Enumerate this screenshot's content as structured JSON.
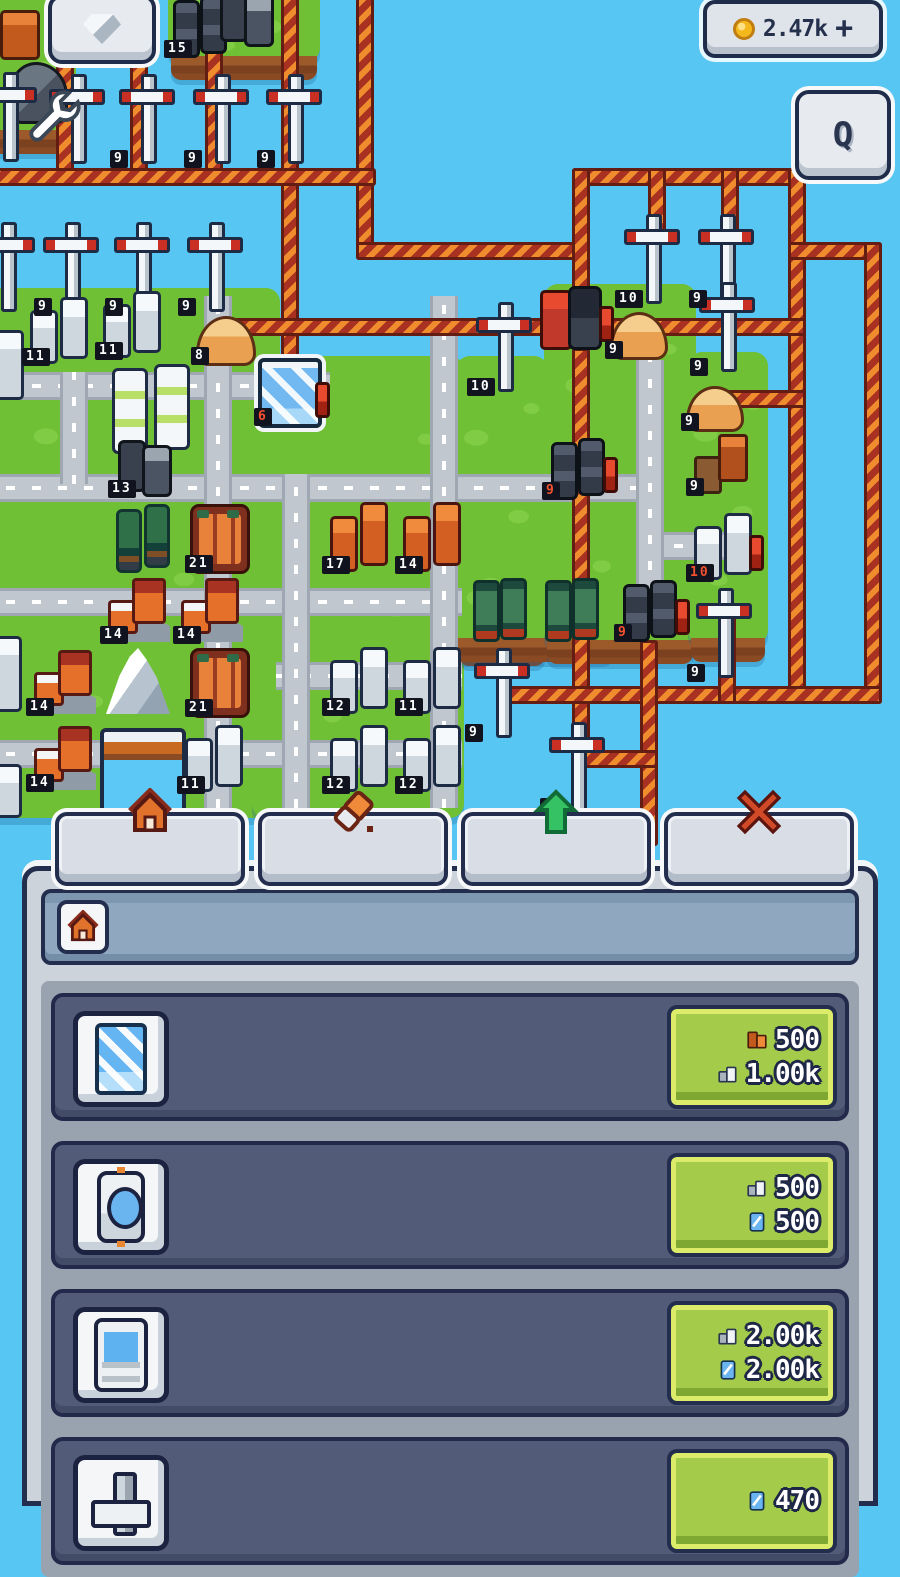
{
  "hud": {
    "gem_button": {
      "icon": "gem-icon"
    },
    "currency": {
      "icon": "coin-icon",
      "value": "2.47k",
      "plus": "+"
    },
    "q_button": {
      "label": "Q"
    },
    "wrench_cursor": {
      "icon": "wrench-icon"
    }
  },
  "tabs": [
    {
      "name": "build",
      "icon": "house-icon"
    },
    {
      "name": "erase",
      "icon": "eraser-icon"
    },
    {
      "name": "upgrade",
      "icon": "arrow-up-icon"
    },
    {
      "name": "close",
      "icon": "x-icon"
    }
  ],
  "panel": {
    "header_icon": "house-icon",
    "items": [
      {
        "icon": "glass-pane",
        "costs": [
          {
            "resource": "bricks",
            "amount": "500"
          },
          {
            "resource": "stone",
            "amount": "1.00k"
          }
        ]
      },
      {
        "icon": "watch",
        "costs": [
          {
            "resource": "stone",
            "amount": "500"
          },
          {
            "resource": "glass",
            "amount": "500"
          }
        ]
      },
      {
        "icon": "window",
        "costs": [
          {
            "resource": "stone",
            "amount": "2.00k"
          },
          {
            "resource": "glass",
            "amount": "2.00k"
          }
        ]
      },
      {
        "icon": "cross",
        "costs": [
          {
            "resource": "glass",
            "amount": "470"
          }
        ]
      }
    ]
  },
  "colors": {
    "water": "#58c6f3",
    "grass": "#70c035",
    "cliff": "#9c5a2b",
    "pipe_orange": "#ef8c2e",
    "pipe_red": "#a93121",
    "road": "#c0c7cf",
    "panel_slate": "#525c79",
    "cost_green": "#a4cc4a",
    "accent_navy": "#232d4d",
    "badge_bg": "#11141f",
    "badge_red_text": "#f4502e",
    "coin_gold": "#f5b81c"
  },
  "map": {
    "islands": [
      {
        "x": -20,
        "y": -16,
        "w": 96,
        "h": 152,
        "cliff": true
      },
      {
        "x": 168,
        "y": -16,
        "w": 152,
        "h": 78,
        "cliff": true
      },
      {
        "x": -20,
        "y": 288,
        "w": 300,
        "h": 530
      },
      {
        "x": 252,
        "y": 356,
        "w": 212,
        "h": 462
      },
      {
        "x": 456,
        "y": 356,
        "w": 92,
        "h": 292,
        "cliff": true
      },
      {
        "x": 440,
        "y": 580,
        "w": 176,
        "h": 64,
        "cliff": true
      },
      {
        "x": 544,
        "y": 284,
        "w": 152,
        "h": 362,
        "cliff": true
      },
      {
        "x": 688,
        "y": 352,
        "w": 80,
        "h": 292,
        "cliff": true
      }
    ],
    "roads": [
      {
        "o": "h",
        "x": -20,
        "y": 372,
        "l": 350
      },
      {
        "o": "h",
        "x": -20,
        "y": 474,
        "l": 680
      },
      {
        "o": "h",
        "x": -20,
        "y": 588,
        "l": 482
      },
      {
        "o": "h",
        "x": 276,
        "y": 662,
        "l": 186
      },
      {
        "o": "h",
        "x": -20,
        "y": 740,
        "l": 482
      },
      {
        "o": "h",
        "x": 648,
        "y": 532,
        "l": 92
      },
      {
        "o": "v",
        "x": 60,
        "y": 372,
        "l": 112
      },
      {
        "o": "v",
        "x": 204,
        "y": 296,
        "l": 512
      },
      {
        "o": "v",
        "x": 282,
        "y": 474,
        "l": 334
      },
      {
        "o": "v",
        "x": 430,
        "y": 296,
        "l": 512
      },
      {
        "o": "v",
        "x": 636,
        "y": 360,
        "l": 262
      }
    ],
    "pipes": [
      {
        "o": "v",
        "x": 56,
        "y": -4,
        "l": 182
      },
      {
        "o": "v",
        "x": 130,
        "y": -4,
        "l": 182
      },
      {
        "o": "v",
        "x": 205,
        "y": -4,
        "l": 182
      },
      {
        "o": "v",
        "x": 281,
        "y": -4,
        "l": 400
      },
      {
        "o": "v",
        "x": 356,
        "y": -4,
        "l": 258
      },
      {
        "o": "h",
        "x": -10,
        "y": 168,
        "l": 380
      },
      {
        "o": "h",
        "x": 572,
        "y": 168,
        "l": 228
      },
      {
        "o": "h",
        "x": 356,
        "y": 242,
        "l": 228
      },
      {
        "o": "v",
        "x": 572,
        "y": 168,
        "l": 132
      },
      {
        "o": "v",
        "x": 648,
        "y": 168,
        "l": 70
      },
      {
        "o": "v",
        "x": 721,
        "y": 168,
        "l": 70
      },
      {
        "o": "v",
        "x": 788,
        "y": 168,
        "l": 528
      },
      {
        "o": "h",
        "x": 788,
        "y": 242,
        "l": 88
      },
      {
        "o": "v",
        "x": 864,
        "y": 242,
        "l": 456
      },
      {
        "o": "h",
        "x": 228,
        "y": 318,
        "l": 572
      },
      {
        "o": "h",
        "x": 712,
        "y": 390,
        "l": 88
      },
      {
        "o": "v",
        "x": 572,
        "y": 348,
        "l": 412
      },
      {
        "o": "h",
        "x": 500,
        "y": 686,
        "l": 376
      },
      {
        "o": "v",
        "x": 640,
        "y": 640,
        "l": 200
      },
      {
        "o": "v",
        "x": 718,
        "y": 610,
        "l": 88
      },
      {
        "o": "h",
        "x": 580,
        "y": 750,
        "l": 72
      }
    ],
    "entities": [
      {
        "type": "crate",
        "x": 0,
        "y": 10
      },
      {
        "type": "rock",
        "x": 10,
        "y": 62
      },
      {
        "type": "vans",
        "x": 172,
        "y": -4,
        "badge": "15"
      },
      {
        "type": "truck",
        "x": 218,
        "y": -10
      },
      {
        "type": "wind-turbine",
        "x": -20,
        "y": 72
      },
      {
        "type": "wind-turbine",
        "x": 48,
        "y": 74
      },
      {
        "type": "wind-turbine",
        "x": 118,
        "y": 74,
        "badge": "9"
      },
      {
        "type": "wind-turbine",
        "x": 192,
        "y": 74,
        "badge": "9"
      },
      {
        "type": "wind-turbine",
        "x": 265,
        "y": 74,
        "badge": "9"
      },
      {
        "type": "wind-turbine",
        "x": -22,
        "y": 222
      },
      {
        "type": "wind-turbine",
        "x": 42,
        "y": 222,
        "badge": "9"
      },
      {
        "type": "wind-turbine",
        "x": 113,
        "y": 222,
        "badge": "9"
      },
      {
        "type": "wind-turbine",
        "x": 186,
        "y": 222,
        "badge": "9"
      },
      {
        "type": "wind-turbine",
        "x": 623,
        "y": 214,
        "badge": "10"
      },
      {
        "type": "wind-turbine",
        "x": 697,
        "y": 214,
        "badge": "9"
      },
      {
        "type": "wind-turbine",
        "x": 698,
        "y": 282,
        "badge": "9"
      },
      {
        "type": "wind-turbine",
        "x": 475,
        "y": 302,
        "badge": "10"
      },
      {
        "type": "wind-turbine",
        "x": 473,
        "y": 648,
        "badge": "9"
      },
      {
        "type": "wind-turbine",
        "x": 548,
        "y": 722,
        "badge": "9"
      },
      {
        "type": "wind-turbine",
        "x": 695,
        "y": 588,
        "badge": "9"
      },
      {
        "type": "white-towers",
        "x": 30,
        "y": 298,
        "badge": "11"
      },
      {
        "type": "white-towers",
        "x": 103,
        "y": 292,
        "badge": "11"
      },
      {
        "type": "sand-pile",
        "x": 196,
        "y": 316,
        "badge": "8"
      },
      {
        "type": "glass-building",
        "x": 258,
        "y": 358,
        "badge": "6",
        "red": true,
        "bar": true
      },
      {
        "type": "greenhouse",
        "x": 112,
        "y": 364
      },
      {
        "type": "tower-edge",
        "x": -14,
        "y": 330
      },
      {
        "type": "truck",
        "x": 116,
        "y": 440,
        "badge": "13"
      },
      {
        "type": "trees",
        "x": 116,
        "y": 504
      },
      {
        "type": "brick-pile",
        "x": 190,
        "y": 504,
        "badge": "21"
      },
      {
        "type": "orange-towers",
        "x": 330,
        "y": 504,
        "badge": "17"
      },
      {
        "type": "orange-towers",
        "x": 403,
        "y": 504,
        "badge": "14"
      },
      {
        "type": "orange-crates",
        "x": 694,
        "y": 434,
        "badge": "9"
      },
      {
        "type": "furnace",
        "x": 540,
        "y": 286,
        "bar": true
      },
      {
        "type": "houses",
        "x": 108,
        "y": 578,
        "badge": "14"
      },
      {
        "type": "houses",
        "x": 181,
        "y": 578,
        "badge": "14"
      },
      {
        "type": "vans",
        "x": 550,
        "y": 438,
        "badge": "9",
        "red": true,
        "bar": true
      },
      {
        "type": "white-towers",
        "x": 694,
        "y": 514,
        "badge": "10",
        "red": true,
        "bar": true
      },
      {
        "type": "green-crates",
        "x": 472,
        "y": 576
      },
      {
        "type": "green-crates",
        "x": 544,
        "y": 576
      },
      {
        "type": "vans",
        "x": 622,
        "y": 580,
        "badge": "9",
        "red": true,
        "bar": true
      },
      {
        "type": "houses",
        "x": 34,
        "y": 650,
        "badge": "14"
      },
      {
        "type": "mountain",
        "x": 106,
        "y": 648
      },
      {
        "type": "brick-pile",
        "x": 190,
        "y": 648,
        "badge": "21"
      },
      {
        "type": "white-towers",
        "x": 330,
        "y": 648,
        "badge": "12"
      },
      {
        "type": "white-towers",
        "x": 403,
        "y": 648,
        "badge": "11"
      },
      {
        "type": "houses",
        "x": 34,
        "y": 726,
        "badge": "14"
      },
      {
        "type": "pool",
        "x": 100,
        "y": 728
      },
      {
        "type": "white-towers",
        "x": 185,
        "y": 726,
        "badge": "11"
      },
      {
        "type": "white-towers",
        "x": 330,
        "y": 726,
        "badge": "12"
      },
      {
        "type": "white-towers",
        "x": 403,
        "y": 726,
        "badge": "12"
      },
      {
        "type": "sand-pile",
        "x": 610,
        "y": 312,
        "w": 52,
        "h": 42,
        "badge": "9"
      },
      {
        "type": "sand-pile",
        "x": 686,
        "y": 386,
        "w": 52,
        "h": 40,
        "badge": "9"
      },
      {
        "type": "tower-edge",
        "x": -16,
        "y": 636,
        "h": 70
      },
      {
        "type": "tower-edge",
        "x": -16,
        "y": 764,
        "h": 48
      }
    ]
  }
}
